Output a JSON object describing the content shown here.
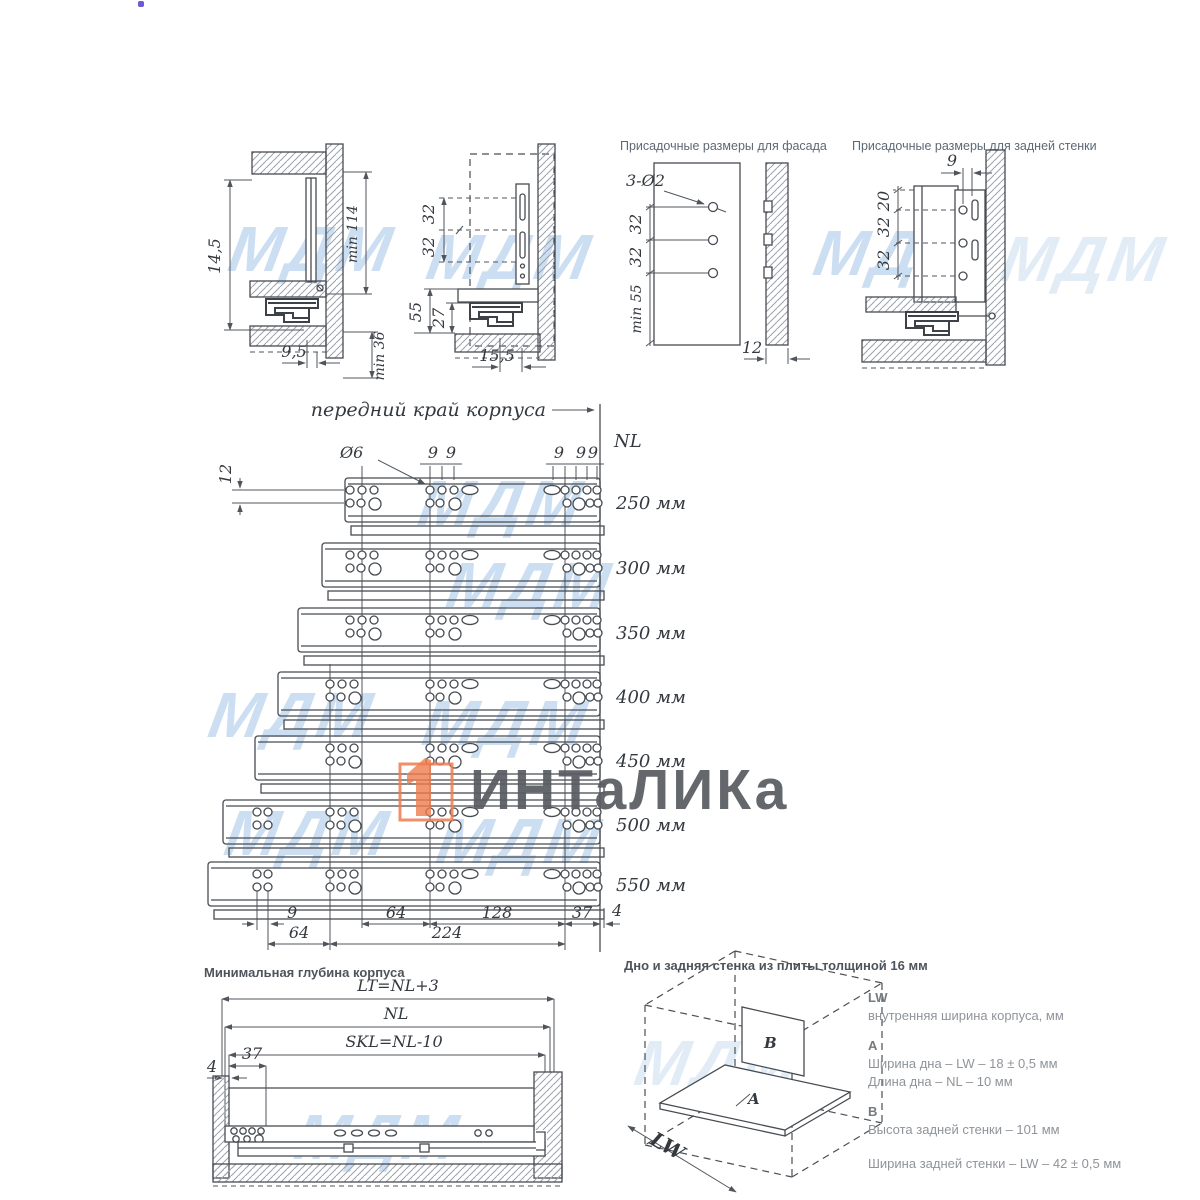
{
  "watermark": {
    "text": "МДМ"
  },
  "logo": {
    "text": "ИНТаЛИКа",
    "accent": "#ee7c4e"
  },
  "panels": {
    "side1": {
      "d_height": "14,5",
      "d_min114": "min 114",
      "d_offset": "9,5",
      "d_min36": "min 36"
    },
    "side2": {
      "d32a": "32",
      "d32b": "32",
      "d55": "55",
      "d27": "27",
      "d155": "15,5"
    },
    "facade": {
      "title": "Присадочные размеры для фасада",
      "leader": "3-Ø2",
      "d32a": "32",
      "d32b": "32",
      "dmin55": "min 55",
      "d12": "12"
    },
    "back": {
      "title": "Присадочные размеры для задней стенки",
      "d9": "9",
      "d20": "20",
      "d32a": "32",
      "d32b": "32"
    }
  },
  "main": {
    "front_edge": "передний край корпуса",
    "nl": "NL",
    "dia": "Ø6",
    "d12": "12",
    "nine": "9",
    "slides": [
      "250 мм",
      "300 мм",
      "350 мм",
      "400 мм",
      "450 мм",
      "500 мм",
      "550 мм"
    ],
    "dims": {
      "d9": "9",
      "d64a": "64",
      "d128": "128",
      "d37": "37",
      "d4": "4",
      "d64b": "64",
      "d224": "224"
    }
  },
  "mindepth": {
    "title": "Минимальная глубина корпуса",
    "lt": "LT=NL+3",
    "nl": "NL",
    "skl": "SKL=NL-10",
    "d37": "37",
    "d4": "4"
  },
  "board": {
    "title": "Дно и задняя стенка из плиты толщиной 16 мм",
    "lw": "LW",
    "a": "A",
    "b": "B",
    "notes": [
      {
        "h": "LW",
        "l1": "внутренняя ширина корпуса, мм",
        "l2": ""
      },
      {
        "h": "A",
        "l1": "Ширина дна – LW – 18 ± 0,5 мм",
        "l2": "Длина дна – NL – 10 мм"
      },
      {
        "h": "B",
        "l1": "Высота задней стенки – 101 мм",
        "l2": ""
      },
      {
        "h": "",
        "l1": "Ширина задней стенки – LW – 42 ± 0,5 мм",
        "l2": ""
      }
    ]
  }
}
